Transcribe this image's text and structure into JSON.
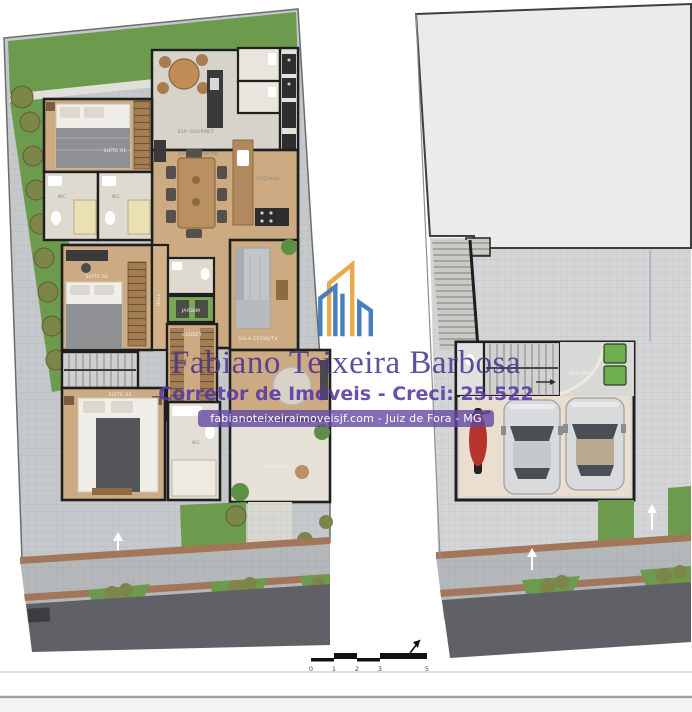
{
  "watermark": {
    "name": "Fabiano Teixeira Barbosa",
    "subtitle": "Corretor de Imóveis - Creci: 25.522",
    "website": "fabianoteixeiraimoveisjf.com - Juiz de Fora - MG"
  },
  "plans": {
    "left": {
      "title": "upper floor plan",
      "labels": {
        "gourmet": "ESP. GOURMET",
        "dining": "SALA DE JANTAR",
        "kitchen": "COZINHA",
        "suite1": "SUÍTE 01",
        "suite2": "SUÍTE 02",
        "suite3": "SUÍTE 03",
        "wc1": "WC",
        "wc2": "WC",
        "wc3": "WC",
        "hall": "HALL",
        "closet": "CLOSET",
        "garden": "JARDIM",
        "living": "SALA ESTAR/TV",
        "varanda": "VARANDA"
      }
    },
    "right": {
      "title": "ground floor plan",
      "labels": {
        "garage": "GARAGEM",
        "depwc": "DEP./WC"
      }
    }
  },
  "scale_bar": {
    "ticks": [
      "0",
      "1",
      "2",
      "3",
      "5"
    ]
  },
  "colors": {
    "lawn": "#6d9b4e",
    "bush": "#7e8549",
    "paving": "#c6c9cb",
    "sidewalk": "#b5b8bb",
    "road": "#5f6166",
    "curb": "#a3765a",
    "wood": "#cdab82",
    "tile": "#dedacf",
    "wall": "#1f1f1f",
    "slab": "#ebebe9",
    "garage_floor": "#eadfce",
    "watermark_purple": "#4a3190",
    "watermark_purple2": "#5639a6",
    "pill_bg": "#6448a3",
    "logo_orange": "#e8a33d",
    "logo_blue": "#3b76b5"
  }
}
